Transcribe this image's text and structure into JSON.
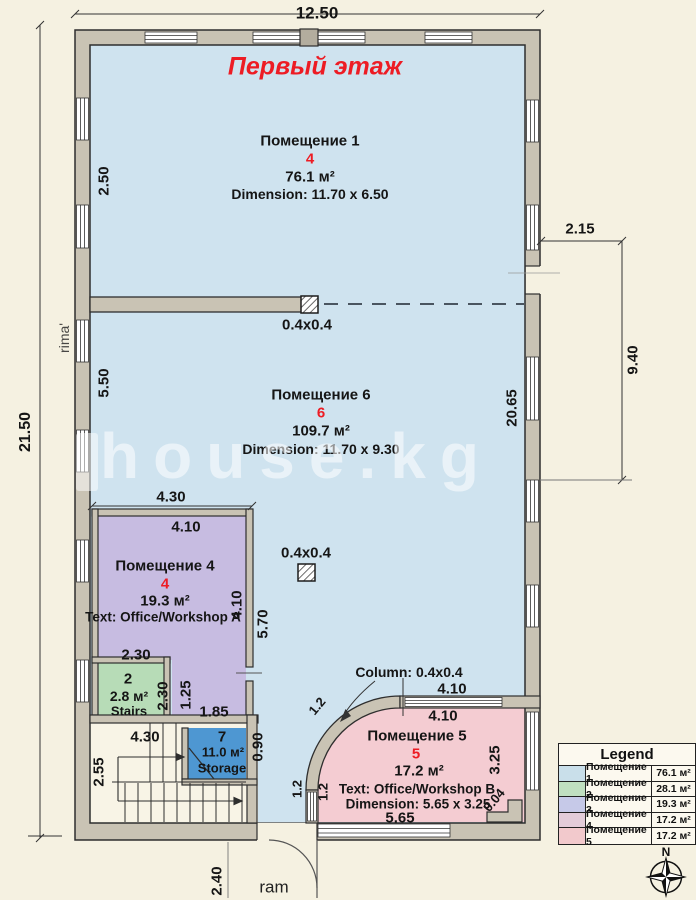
{
  "title": "Первый этаж",
  "rooms": {
    "r1": {
      "name": "Помещение 1",
      "number": "4",
      "area": "76.1 м²",
      "dim": "Dimension: 11.70 x 6.50"
    },
    "r6": {
      "name": "Помещение 6",
      "number": "6",
      "area": "109.7 м²",
      "dim": "Dimension: 11.70 x 9.30"
    },
    "r4": {
      "name": "Помещение 4",
      "number": "4",
      "area": "19.3 м²",
      "text": "Text: Office/Workshop A"
    },
    "r2": {
      "number": "2",
      "area": "2.8 м²",
      "label": "Stairs"
    },
    "r7": {
      "number": "7",
      "area": "11.0 м²",
      "label": "Storage"
    },
    "r5": {
      "name": "Помещение 5",
      "number": "5",
      "area": "17.2 м²",
      "text": "Text: Office/Workshop B",
      "dim": "Dimension: 5.65 x 3.25"
    }
  },
  "columns": {
    "label_a": "0.4x0.4",
    "label_b": "0.4x0.4",
    "annotation": "Column: 0.4x0.4"
  },
  "dims": {
    "total_width": "12.50",
    "total_height": "21.50",
    "left_top": "2.50",
    "left_mid": "5.50",
    "right_inner": "20.65",
    "ext_width": "2.15",
    "ext_height": "9.40",
    "r4_out_top": "4.30",
    "r4_in_top": "4.10",
    "r4_in_right": "4.10",
    "r4_out_right": "5.70",
    "r4_low_width": "2.30",
    "r2_height": "2.30",
    "ext_left": "1.25",
    "ext_bottom": "1.85",
    "stair_width": "4.30",
    "stair_height": "2.55",
    "r7_right": "0.90",
    "r5_out_top": "4.10",
    "r5_in_top": "4.10",
    "r5_bottom": "5.65",
    "r5_right": "3.25",
    "r5_corner": "0.04",
    "arc_top": "1.2",
    "arc_left_a": "1.2",
    "arc_left_b": "1.2",
    "door_bottom": "2.40"
  },
  "watermark": {
    "brand": "house.kg",
    "side": "rima'",
    "bottom": "ram"
  },
  "legend": {
    "title": "Legend",
    "rows": [
      {
        "name": "Помещение 1",
        "area": "76.1 м²",
        "color": "#c9dfea"
      },
      {
        "name": "Помещение 2",
        "area": "28.1 м²",
        "color": "#c0dfc0"
      },
      {
        "name": "Помещение 3",
        "area": "19.3 м²",
        "color": "#c6c9e8"
      },
      {
        "name": "Помещение 4",
        "area": "17.2 м²",
        "color": "#e3ccd9"
      },
      {
        "name": "Помещение 5",
        "area": "17.2 м²",
        "color": "#f2c9cc"
      }
    ]
  },
  "compass": {
    "north": "N"
  }
}
